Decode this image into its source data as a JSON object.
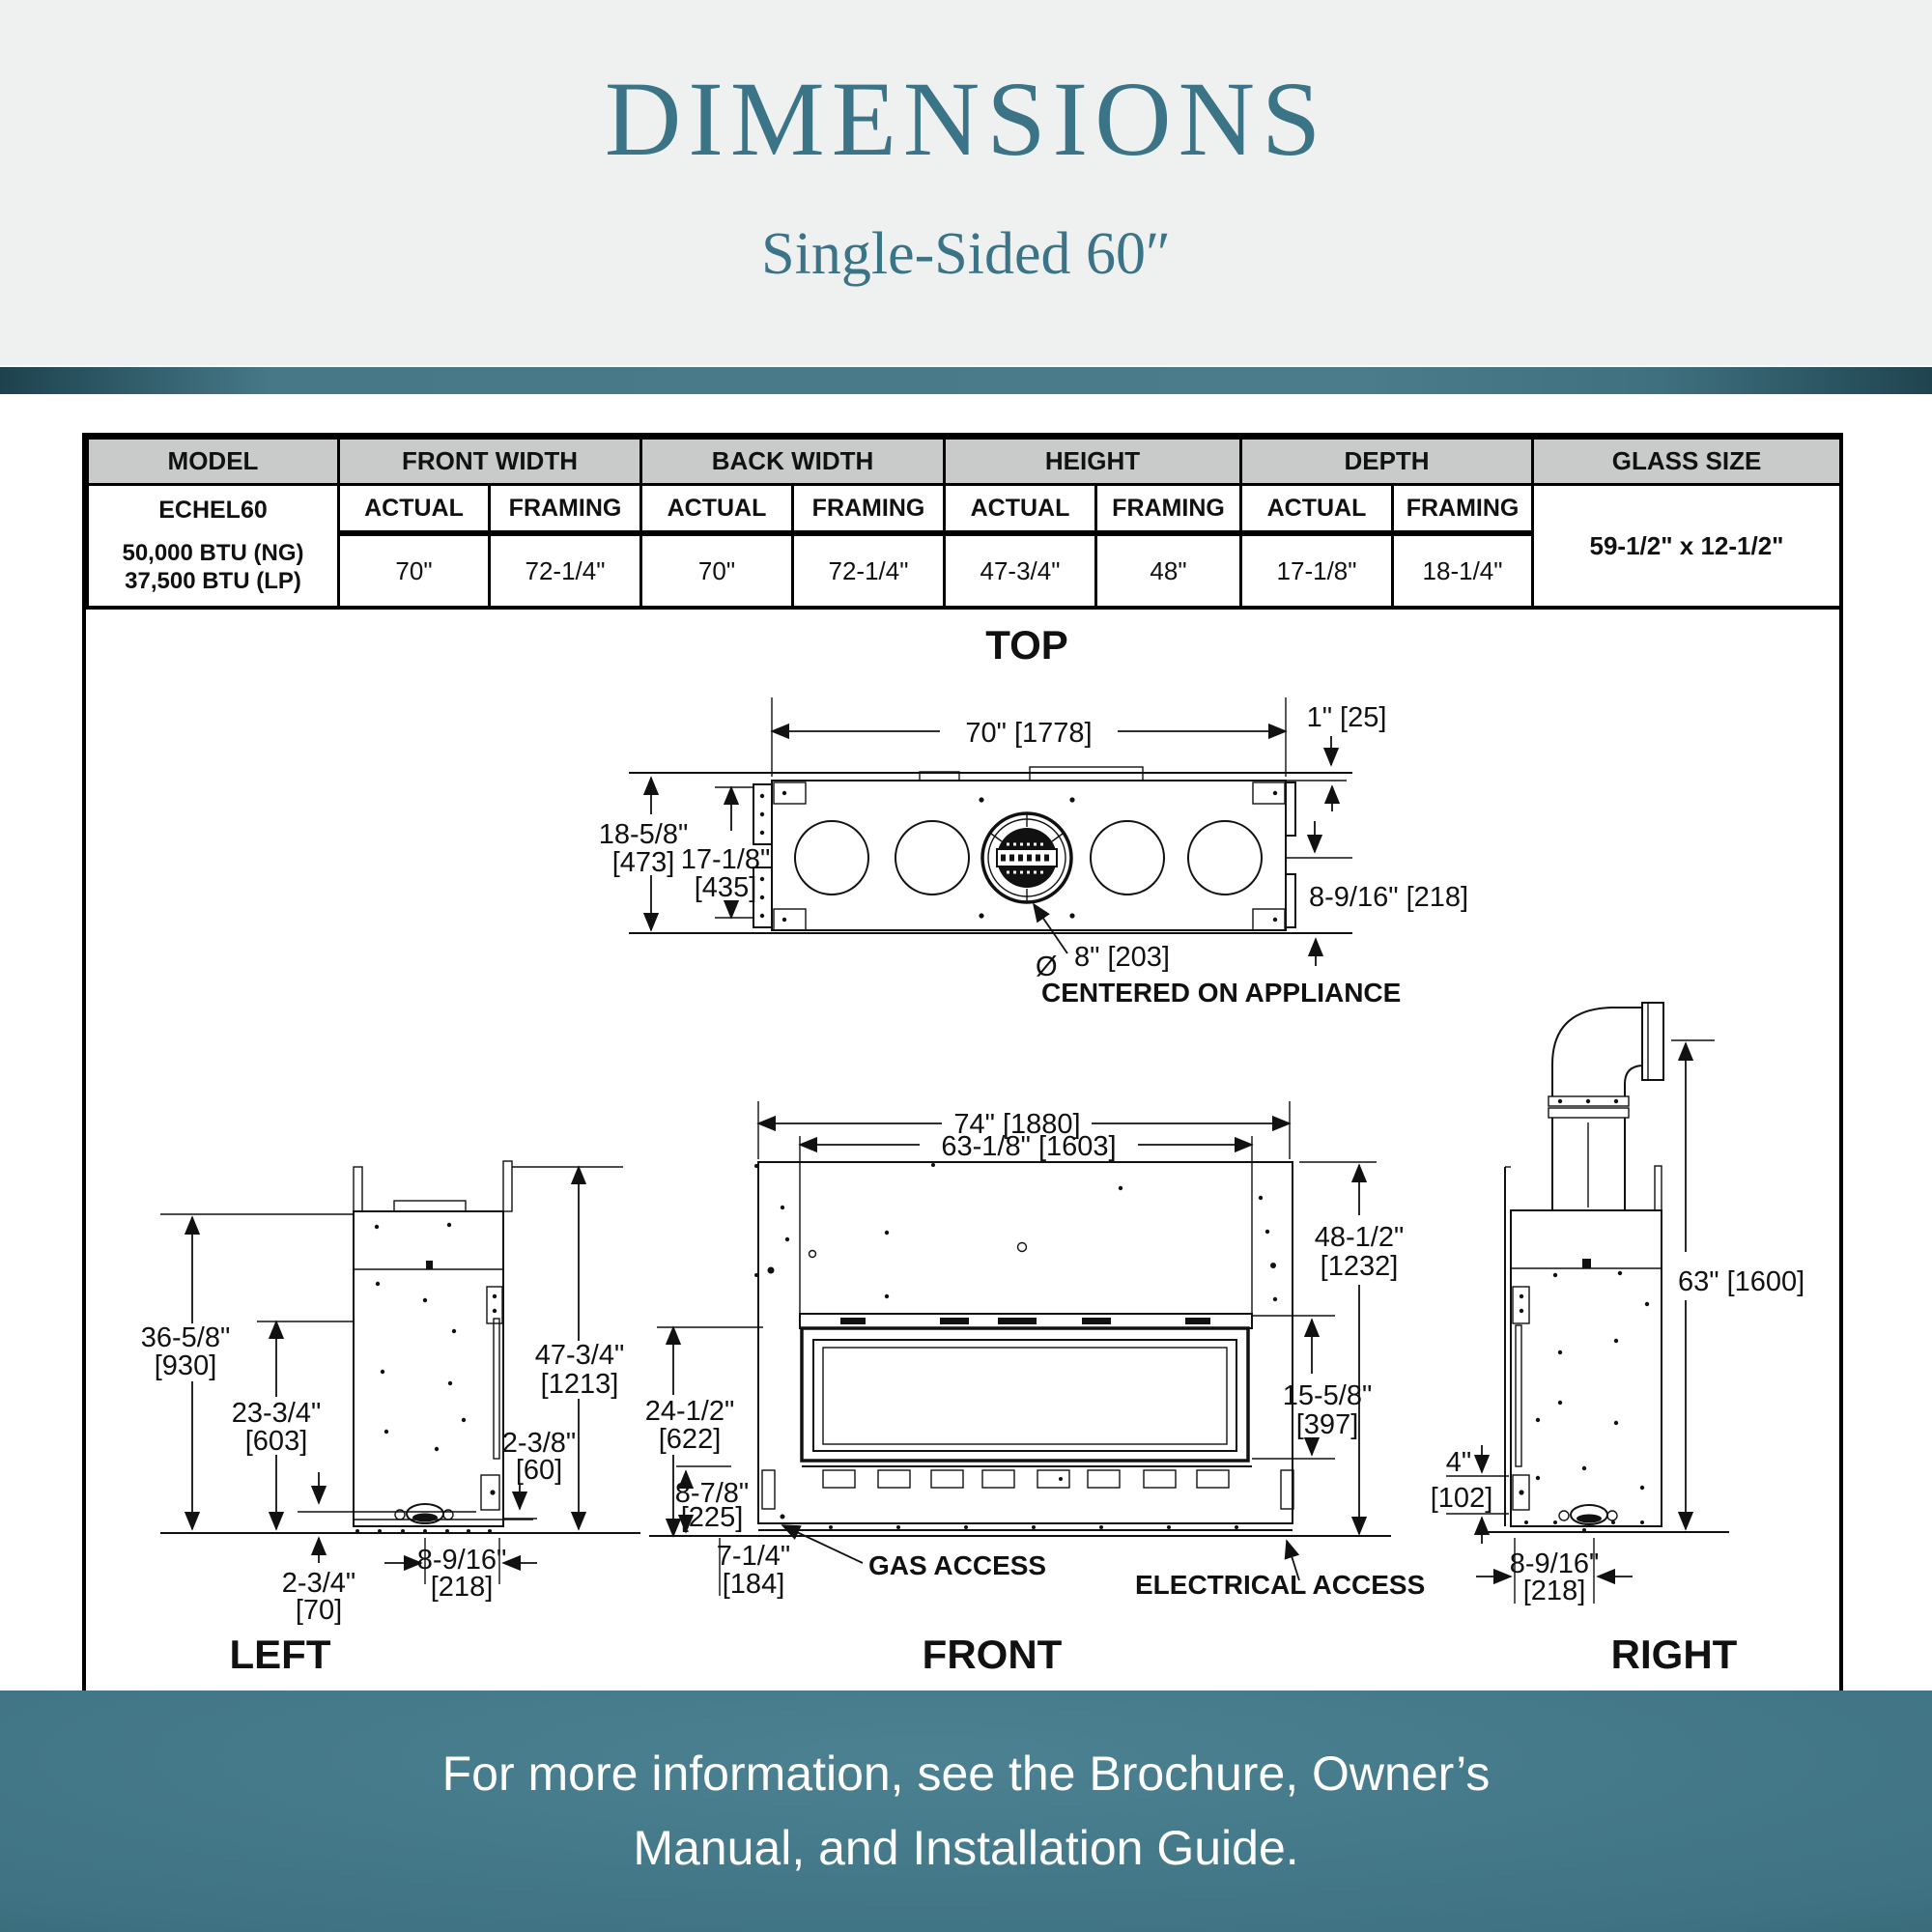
{
  "header": {
    "title": "DIMENSIONS",
    "subtitle": "Single-Sided 60″"
  },
  "colors": {
    "accent_teal": "#3b7486",
    "band_dark": "#1d424e",
    "band_light": "#4a7c8c",
    "table_header_bg": "#c9cbcb",
    "line_color": "#111111",
    "header_bg": "#eff1f1"
  },
  "table": {
    "columns": [
      "MODEL",
      "FRONT WIDTH",
      "BACK WIDTH",
      "HEIGHT",
      "DEPTH",
      "GLASS SIZE"
    ],
    "sub_headers": [
      "ACTUAL",
      "FRAMING",
      "ACTUAL",
      "FRAMING",
      "ACTUAL",
      "FRAMING",
      "ACTUAL",
      "FRAMING"
    ],
    "model": {
      "name": "ECHEL60",
      "btu_ng": "50,000 BTU (NG)",
      "btu_lp": "37,500 BTU (LP)"
    },
    "values": [
      "70\"",
      "72-1/4\"",
      "70\"",
      "72-1/4\"",
      "47-3/4\"",
      "48\"",
      "17-1/8\"",
      "18-1/4\""
    ],
    "glass_size": "59-1/2\" x 12-1/2\""
  },
  "views": {
    "top": {
      "title": "TOP",
      "dims": {
        "w": "70\" [1778]",
        "off": "1\" [25]",
        "do1": "18-5/8\"",
        "do2": "[473]",
        "di1": "17-1/8\"",
        "di2": "[435]",
        "half": "8-9/16\" [218]",
        "vent_sym": "Ø",
        "vent": "8\" [203]",
        "vent_note": "CENTERED ON APPLIANCE"
      }
    },
    "left": {
      "title": "LEFT",
      "dims": {
        "h1a": "36-5/8\"",
        "h1b": "[930]",
        "h2a": "23-3/4\"",
        "h2b": "[603]",
        "h3a": "47-3/4\"",
        "h3b": "[1213]",
        "o1a": "2-3/8\"",
        "o1b": "[60]",
        "o2a": "2-3/4\"",
        "o2b": "[70]",
        "da": "8-9/16\"",
        "db": "[218]"
      }
    },
    "front": {
      "title": "FRONT",
      "dims": {
        "w1": "74\" [1880]",
        "w2": "63-1/8\" [1603]",
        "h1a": "48-1/2\"",
        "h1b": "[1232]",
        "h2a": "24-1/2\"",
        "h2b": "[622]",
        "ga": "15-5/8\"",
        "gb": "[397]",
        "ba": "8-7/8\"",
        "bb": "[225]",
        "fa": "7-1/4\"",
        "fb": "[184]",
        "gas": "GAS ACCESS",
        "elec": "ELECTRICAL ACCESS"
      }
    },
    "right": {
      "title": "RIGHT",
      "dims": {
        "h": "63\" [1600]",
        "va": "4\"",
        "vb": "[102]",
        "da": "8-9/16\"",
        "db": "[218]"
      }
    }
  },
  "footer": {
    "line1": "For more information, see the Brochure, Owner’s",
    "line2": "Manual, and Installation Guide."
  }
}
